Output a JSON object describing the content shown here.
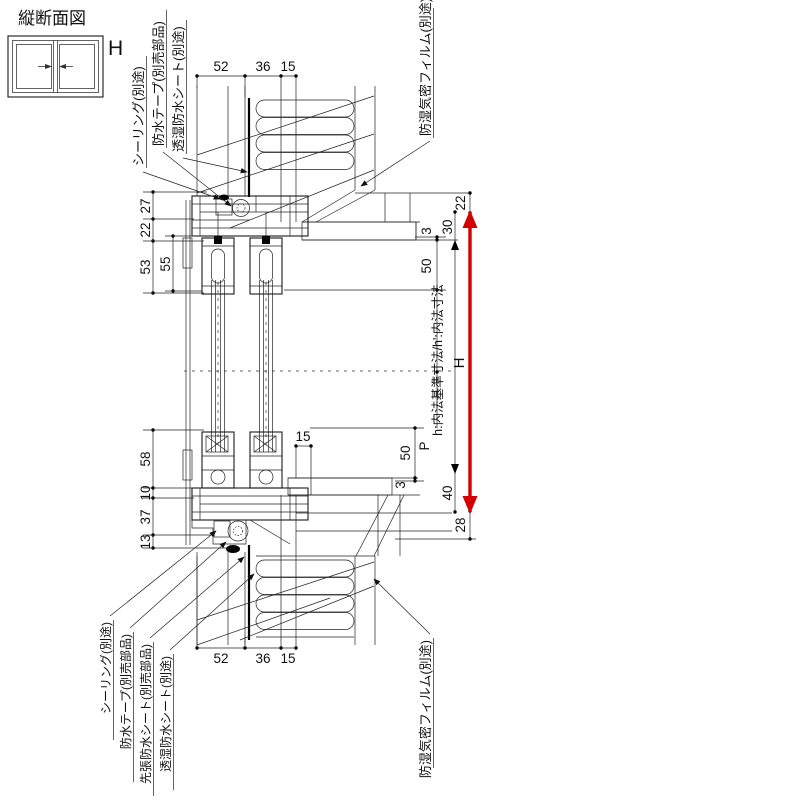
{
  "title": "縦断面図",
  "window_icon": {
    "height_label": "H"
  },
  "callouts": {
    "top_left": [
      "シーリング(別途)",
      "防水テープ(別売部品)",
      "透湿防水シート(別途)"
    ],
    "top_right": "防湿気密フィルム(別途)",
    "bottom_left": [
      "シーリング(別途)",
      "防水テープ(別売部品)",
      "先張防水シート(別売部品)",
      "透湿防水シート(別途)"
    ],
    "bottom_right": "防湿気密フィルム(別途)"
  },
  "dims": {
    "top": [
      "52",
      "36",
      "15"
    ],
    "bottom": [
      "52",
      "36",
      "15"
    ],
    "left_upper": [
      "27",
      "22",
      "53",
      "55"
    ],
    "left_lower": [
      "58",
      "10",
      "37",
      "13"
    ],
    "right_upper": [
      "22",
      "30",
      "3",
      "50"
    ],
    "right_lower": [
      "50",
      "3",
      "40",
      "28"
    ],
    "sill_inner": "15",
    "pitch": "P",
    "height": "H",
    "inner_note": "h:内法基準寸法/h':内法寸法"
  },
  "colors": {
    "arrow": "#d40000",
    "line": "#000000",
    "background": "#ffffff"
  }
}
